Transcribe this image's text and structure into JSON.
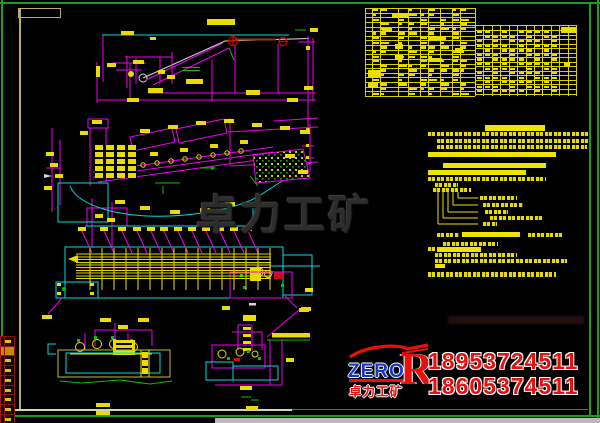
{
  "watermark": {
    "text": "卓力工矿"
  },
  "faint_watermark": {
    "present": true
  },
  "logo": {
    "brand": "ZERO",
    "brand_mark": "R",
    "subtitle_cn": "卓力工矿",
    "phone1": "18953724511",
    "phone2": "18605374511",
    "brand_color": "#1535cc",
    "accent_color": "#e8100c"
  },
  "colors": {
    "background": "#000000",
    "frame_green": "#1f9b1f",
    "sheet_frame": "#b9ad6c",
    "cad_magenta": "#f000f0",
    "cad_cyan": "#00dede",
    "cad_yellow": "#e8dc00",
    "cad_green": "#00c400",
    "cad_red": "#d80000",
    "watermark_gray": "#2d2d2d"
  },
  "bom_table": {
    "x": 365,
    "y": 8,
    "w": 211,
    "h": 88,
    "title_bar": [
      27,
      5,
      16,
      5
    ],
    "left_cols": [
      0,
      7,
      15,
      33,
      43,
      55,
      63,
      75,
      87,
      95,
      110
    ],
    "left_rows": 19,
    "left_row_h": 4.63,
    "right_x": 110,
    "right_w": 101,
    "right_y": 22,
    "right_rows": 14,
    "right_row_h": 4.54,
    "right_col_w": 8.42,
    "header_line": [
      65,
      17,
      211
    ],
    "solid_cells": [
      [
        196,
        19,
        15,
        6
      ],
      [
        3,
        62,
        12,
        8
      ],
      [
        3,
        74,
        10,
        6
      ],
      [
        30,
        36,
        8,
        5
      ],
      [
        30,
        47,
        8,
        5
      ],
      [
        63,
        28,
        18,
        4
      ],
      [
        63,
        50,
        14,
        4
      ],
      [
        90,
        40,
        8,
        5
      ],
      [
        17,
        20,
        10,
        4
      ],
      [
        199,
        55,
        6,
        3
      ]
    ]
  },
  "notes": {
    "lines": [
      [
        485,
        125,
        60,
        6,
        "s"
      ],
      [
        428,
        132,
        161,
        4,
        "t"
      ],
      [
        437,
        139,
        152,
        4,
        "t"
      ],
      [
        437,
        145,
        150,
        4,
        "t"
      ],
      [
        428,
        152,
        128,
        5,
        "s"
      ],
      [
        443,
        163,
        103,
        5,
        "s"
      ],
      [
        428,
        170,
        98,
        5,
        "s"
      ],
      [
        428,
        177,
        118,
        4,
        "t"
      ],
      [
        435,
        183,
        23,
        4,
        "t"
      ],
      [
        433,
        188,
        38,
        4,
        "t"
      ],
      [
        437,
        233,
        22,
        4,
        "t"
      ],
      [
        462,
        232,
        58,
        5,
        "s"
      ],
      [
        528,
        233,
        36,
        4,
        "t"
      ],
      [
        443,
        242,
        55,
        4,
        "t"
      ],
      [
        428,
        247,
        8,
        4,
        "t"
      ],
      [
        437,
        247,
        44,
        5,
        "s"
      ],
      [
        435,
        253,
        82,
        4,
        "t"
      ],
      [
        435,
        259,
        132,
        4,
        "t"
      ],
      [
        435,
        264,
        10,
        4,
        "s"
      ],
      [
        428,
        272,
        128,
        5,
        "t"
      ]
    ],
    "callout_labels": [
      [
        480,
        196,
        37,
        4
      ],
      [
        483,
        203,
        40,
        4
      ],
      [
        485,
        210,
        23,
        4
      ],
      [
        490,
        216,
        54,
        4
      ],
      [
        483,
        222,
        14,
        4
      ]
    ]
  },
  "left_strip": {
    "rows": 9,
    "row_h": 9.7,
    "highlight_row": 1
  }
}
